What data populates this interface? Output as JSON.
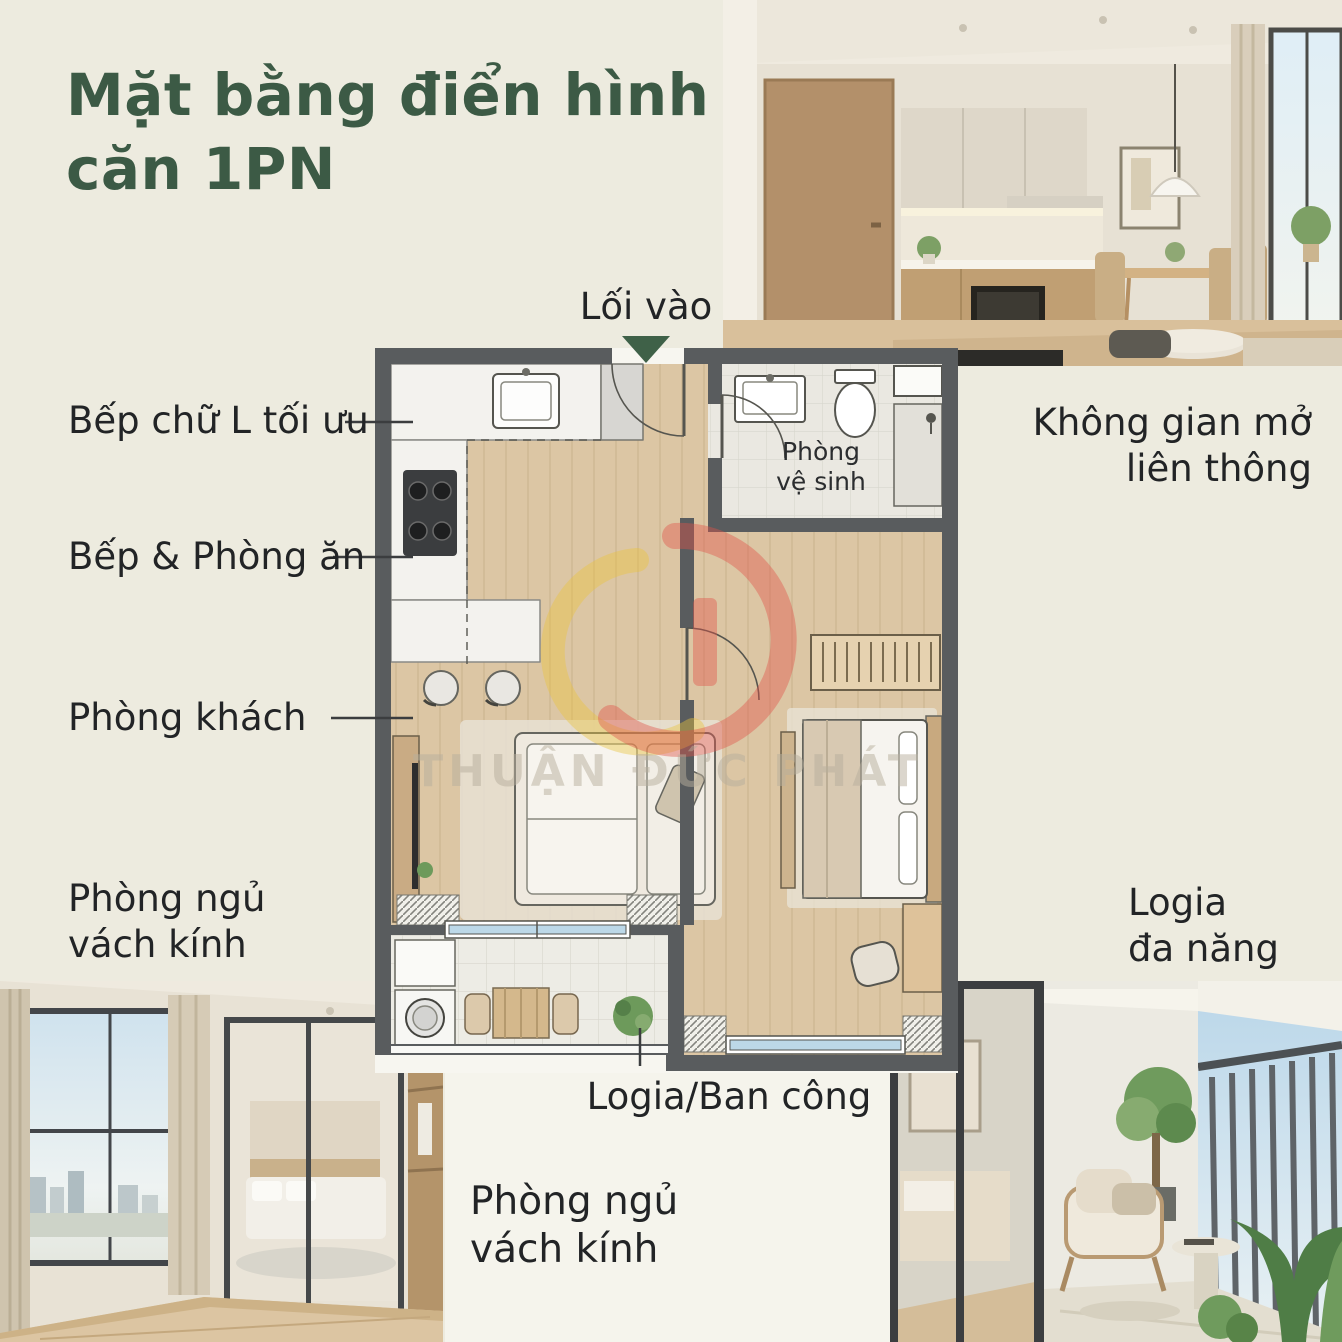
{
  "title": {
    "line1": "Mặt bằng điển hình",
    "line2": "căn 1PN"
  },
  "entrance": {
    "label": "Lối vào"
  },
  "plan": {
    "bathroom_label_line1": "Phòng",
    "bathroom_label_line2": "vệ sinh"
  },
  "callouts": {
    "kitchen_l": "Bếp chữ L tối ưu",
    "kitchen_dining": "Bếp & Phòng ăn",
    "living_room": "Phòng khách",
    "bedroom_glass_line1": "Phòng ngủ",
    "bedroom_glass_line2": "vách kính",
    "open_space_line1": "Không gian mở",
    "open_space_line2": "liên thông",
    "logia_multi_line1": "Logia",
    "logia_multi_line2": "đa năng",
    "logia_balcony": "Logia/Ban công",
    "bedroom_glass_bottom_line1": "Phòng ngủ",
    "bedroom_glass_bottom_line2": "vách kính"
  },
  "watermark": {
    "brand": "THUẬN ĐỨC PHÁT"
  },
  "colors": {
    "background": "#edebdf",
    "panel_white": "#f5f4ec",
    "title_green": "#3c5a45",
    "arrow_green": "#3f6148",
    "text_dark": "#222426",
    "wall_gray": "#595c5e",
    "wood_floor": "#dcc6a4",
    "tile_light": "#edece5",
    "marble_white": "#f3f2ee",
    "glass_blue": "#bcd8e8",
    "watermark_red": "#e0534a",
    "watermark_yellow": "#eac33e"
  }
}
